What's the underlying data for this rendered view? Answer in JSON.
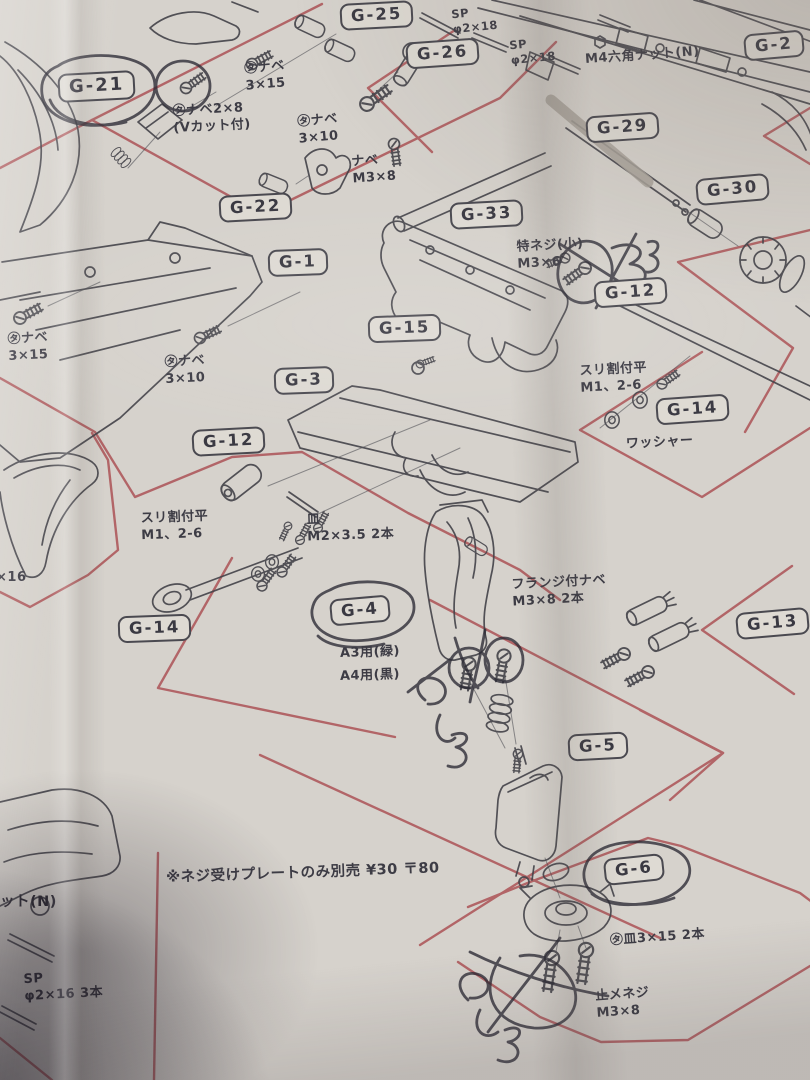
{
  "colors": {
    "paper": "#d6d2cc",
    "red": "#a8474b",
    "ink": "#45444b",
    "pen": "#2a2833",
    "label_bg": "#dedad3"
  },
  "labels": {
    "g25": "G-25",
    "g26": "G-26",
    "g2": "G-2",
    "g21": "G-21",
    "g22": "G-22",
    "g29": "G-29",
    "g30": "G-30",
    "g1": "G-1",
    "g33": "G-33",
    "g12_upper": "G-12",
    "g15": "G-15",
    "g3": "G-3",
    "g14_right": "G-14",
    "g12_left": "G-12",
    "g14_left": "G-14",
    "g4": "G-4",
    "g13": "G-13",
    "g5": "G-5",
    "g6": "G-6"
  },
  "annotations": {
    "sp_2x18_a": "SP\nφ2×18",
    "sp_2x18_b": "SP\nφ2×18",
    "m4_hex_nut": "M4六角ナット(N)",
    "ta_nabe_3x15_top": "㋟ナベ\n3×15",
    "ta_nabe_3x10_top": "㋟ナベ\n3×10",
    "ta_nabe_2x8": "㋟ナベ2×8\n(Vカット付)",
    "nabe_m3x8": "ナベ\nM3×8",
    "toku_neji_small": "特ネジ(小)\nM3×6",
    "ta_nabe_3x15_left": "㋟ナベ\n3×15",
    "ta_nabe_3x10_mid": "㋟ナベ\n3×10",
    "suri_wari_right": "スリ割付平\nM1、2-6",
    "washer": "ワッシャー",
    "suri_wari_left": "スリ割付平\nM1、2-6",
    "sara_m2x35": "皿\nM2×3.5 2本",
    "a3_green": "A3用(緑)",
    "a4_black": "A4用(黒)",
    "flange_nabe": "フランジ付ナベ\nM3×8 2本",
    "separate_sale_note": "※ネジ受けプレートのみ別売 ¥30 〒80",
    "ta_sara_3x15": "㋟皿3×15 2本",
    "tome_neji": "止メネジ\nM3×8",
    "nut_partial": "ット(N)",
    "sp_2x16": "SP\nφ2×16 3本",
    "x16_partial": "×16"
  }
}
